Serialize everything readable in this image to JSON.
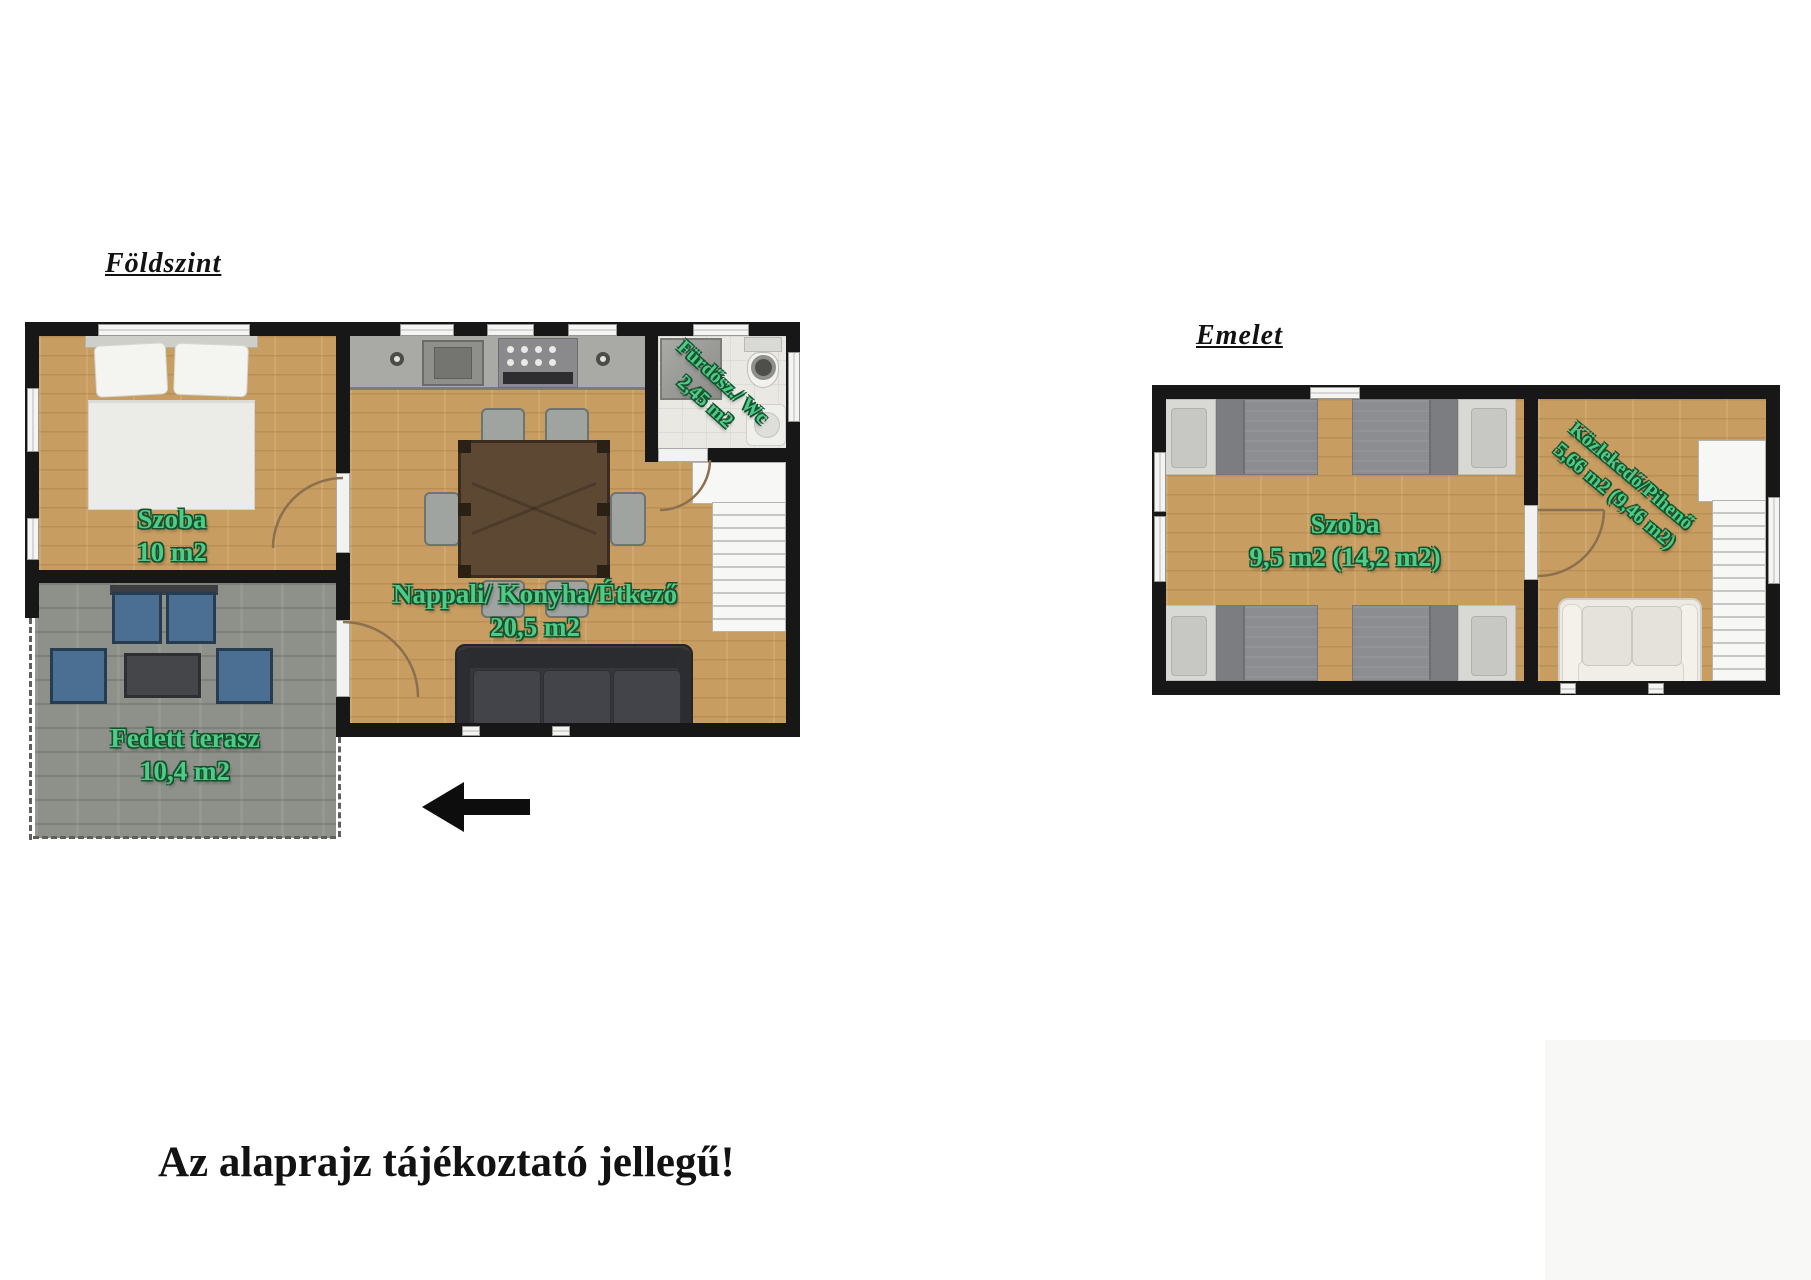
{
  "page": {
    "disclaimer": "Az alaprajz tájékoztató jellegű!"
  },
  "ground_floor": {
    "title": "Földszint",
    "rooms": [
      {
        "id": "szoba",
        "name": "Szoba",
        "area": "10 m2"
      },
      {
        "id": "nappali",
        "name": "Nappali/ Konyha/Étkező",
        "area": "20,5 m2"
      },
      {
        "id": "furdo",
        "name": "Fürdősz./ Wc",
        "area": "2,45 m2"
      },
      {
        "id": "terasz",
        "name": "Fedett terasz",
        "area": "10,4 m2"
      }
    ]
  },
  "upper_floor": {
    "title": "Emelet",
    "rooms": [
      {
        "id": "szoba",
        "name": "Szoba",
        "area": "9,5 m2 (14,2 m2)"
      },
      {
        "id": "kozlekedo",
        "name": "Közlekedő/Pihenő",
        "area": "5,66 m2 (9,46 m2)"
      }
    ]
  },
  "icons": {
    "entrance_arrow": "left-arrow"
  },
  "colors": {
    "label_green": "#4fca87",
    "label_green_outline": "#14532e",
    "wall_black": "#171717",
    "wood_floor": "#c79d61",
    "terrace_floor": "#8e918a",
    "door_arc_brown": "#8b6f4e",
    "terrace_chair_blue": "#4a6f93"
  }
}
